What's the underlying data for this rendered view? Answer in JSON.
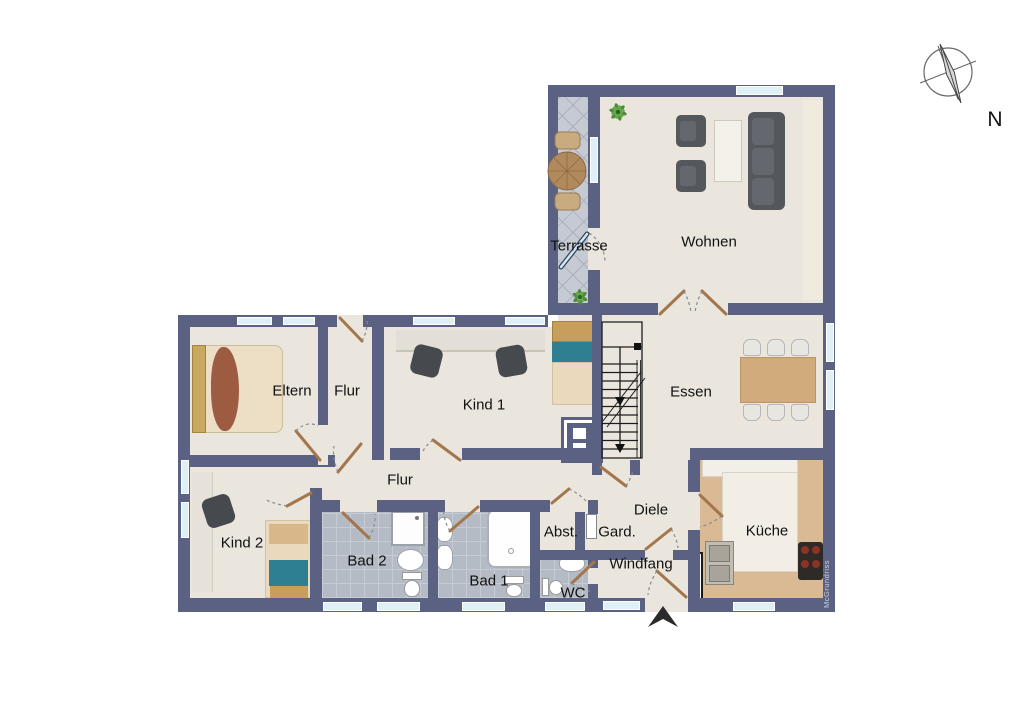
{
  "plan": {
    "title": "Grundriss / floor plan",
    "rooms": {
      "terrasse": {
        "label": "Terrasse"
      },
      "wohnen": {
        "label": "Wohnen"
      },
      "eltern": {
        "label": "Eltern"
      },
      "flur_oben": {
        "label": "Flur"
      },
      "kind1": {
        "label": "Kind 1"
      },
      "essen": {
        "label": "Essen"
      },
      "flur": {
        "label": "Flur"
      },
      "kind2": {
        "label": "Kind 2"
      },
      "bad2": {
        "label": "Bad 2"
      },
      "bad1": {
        "label": "Bad 1"
      },
      "wc": {
        "label": "WC"
      },
      "abst": {
        "label": "Abst."
      },
      "gard": {
        "label": "Gard."
      },
      "diele": {
        "label": "Diele"
      },
      "windfang": {
        "label": "Windfang"
      },
      "kueche": {
        "label": "Küche"
      }
    },
    "compass": {
      "label": "N"
    },
    "watermark": "McGrundriss",
    "colors": {
      "wall": "#5a6183",
      "floor": "#eae6de",
      "tile_gray": "#b4bbc4",
      "terrace_gray": "#c6cad3",
      "window_blue": "#def0f6",
      "counter_tan": "#d9ba95",
      "door_wood": "#a3764c",
      "sofa_gray": "#54575c",
      "bed_teal": "#2e7f92"
    }
  }
}
